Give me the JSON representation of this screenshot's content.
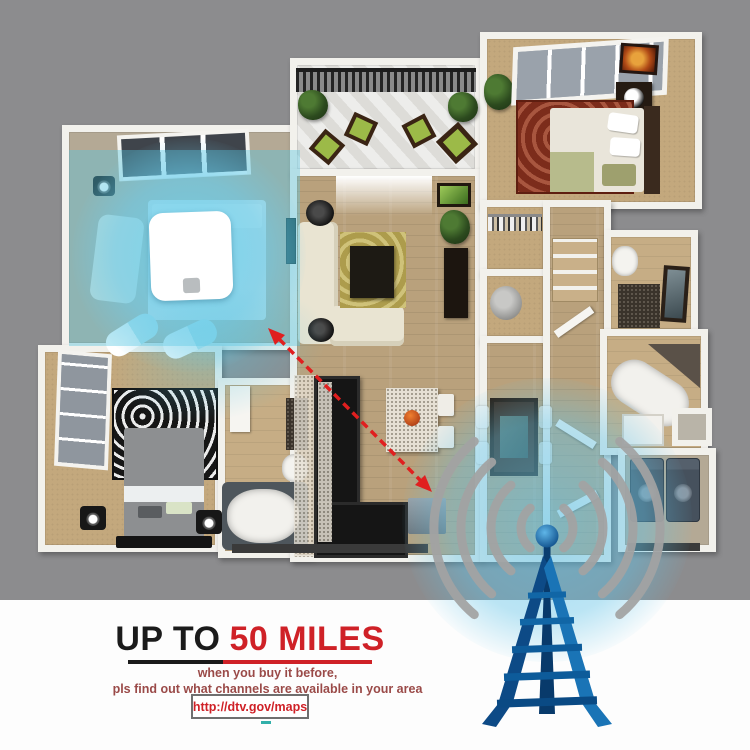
{
  "promo": {
    "headline_prefix": "UP TO",
    "headline_highlight": "50 MILES",
    "subline1": "when you buy it before,",
    "subline2": "pls find out what channels are available in your area",
    "link": "http://dtv.gov/maps"
  },
  "colors": {
    "background_gray": "#8c8c8e",
    "footer_white": "#fdfdfd",
    "accent_red": "#cf2127",
    "headline_black": "#1b1b1b",
    "subtext_dark_red": "#9a4a48",
    "signal_coverage_blue": "#5ec7e6",
    "tower_blue": "#1a74b6",
    "tower_dark_blue": "#0b4a86",
    "signal_wave_gray": "#a3a3a3",
    "range_arrow_red": "#e01f1f",
    "wall_white": "#f2f1ec"
  },
  "icons": {
    "antenna_pad": "flat-indoor-antenna-icon",
    "radio_tower": "broadcast-tower-icon",
    "signal_waves": "signal-waves-icon",
    "range_arrow": "double-headed-dashed-arrow-icon",
    "coverage_glow": "signal-coverage-glow"
  }
}
